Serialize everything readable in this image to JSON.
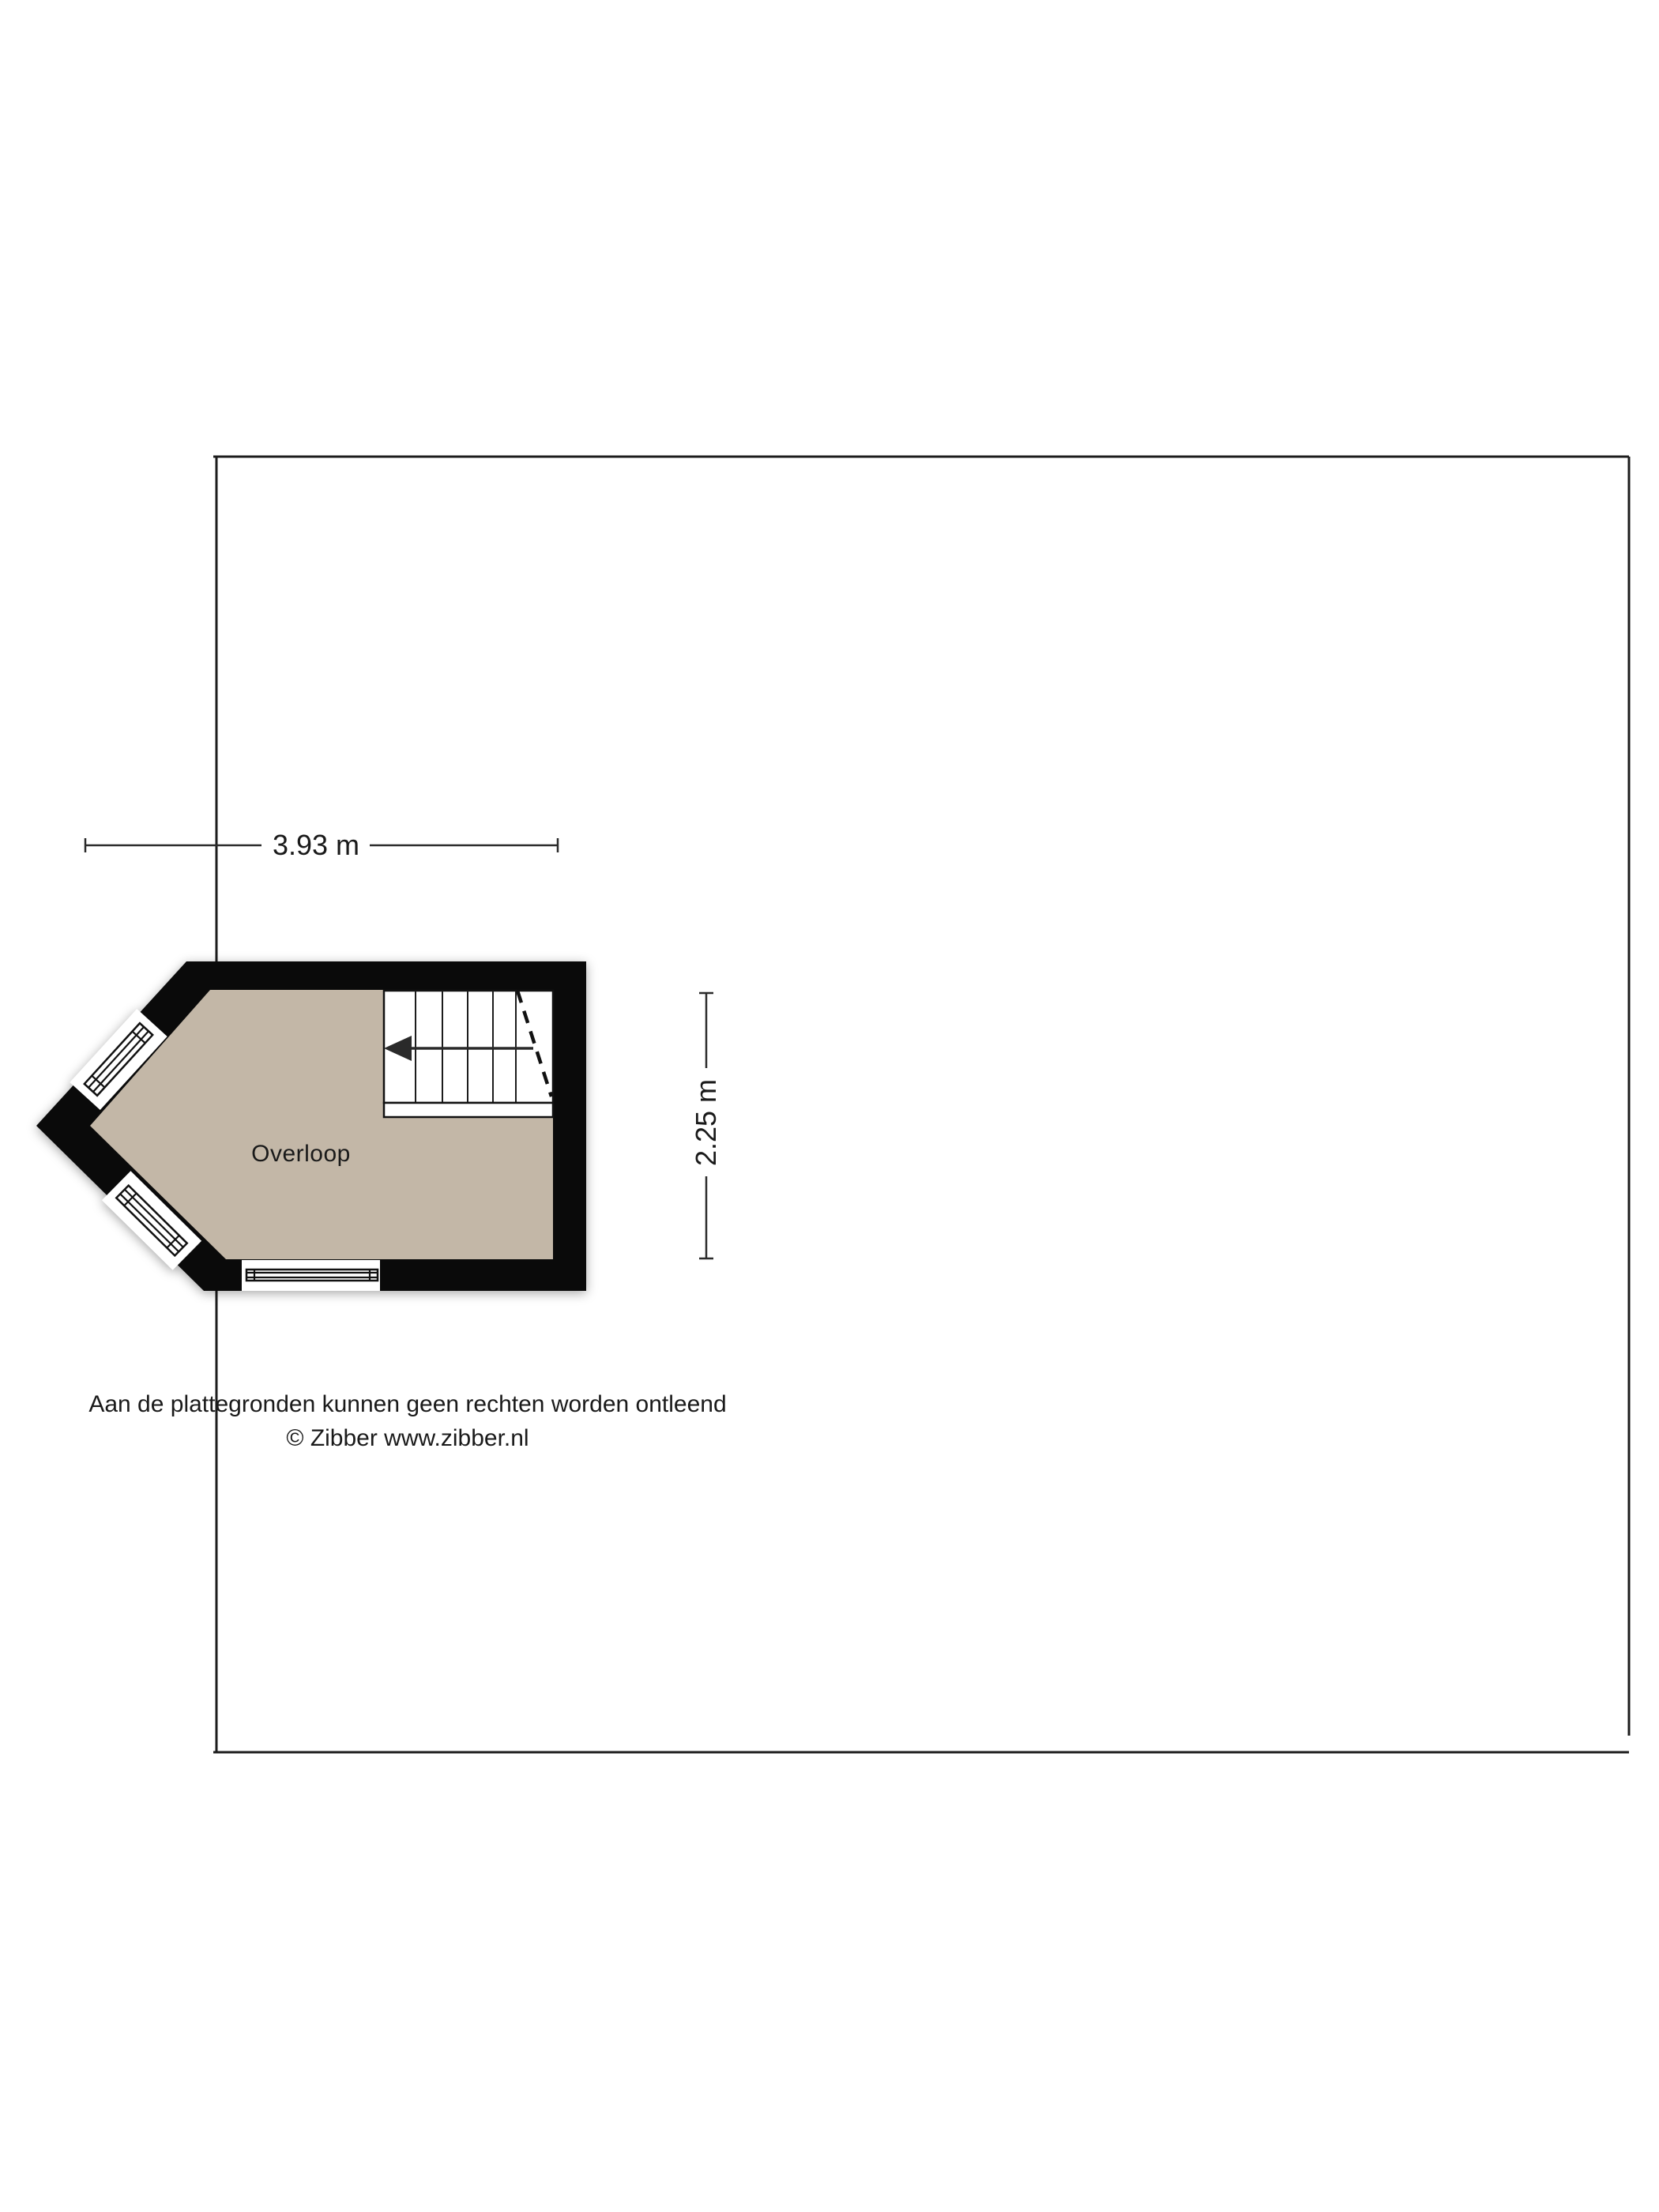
{
  "floorplan": {
    "room_label": "Overloop",
    "colors": {
      "floor": "#c3b7a7",
      "wall": "#0a0a0a"
    }
  },
  "dimensions": {
    "width_label": "3.93 m",
    "height_label": "2.25 m"
  },
  "footer": {
    "disclaimer": "Aan de plattegronden kunnen geen rechten worden ontleend",
    "copyright": "© Zibber www.zibber.nl"
  }
}
